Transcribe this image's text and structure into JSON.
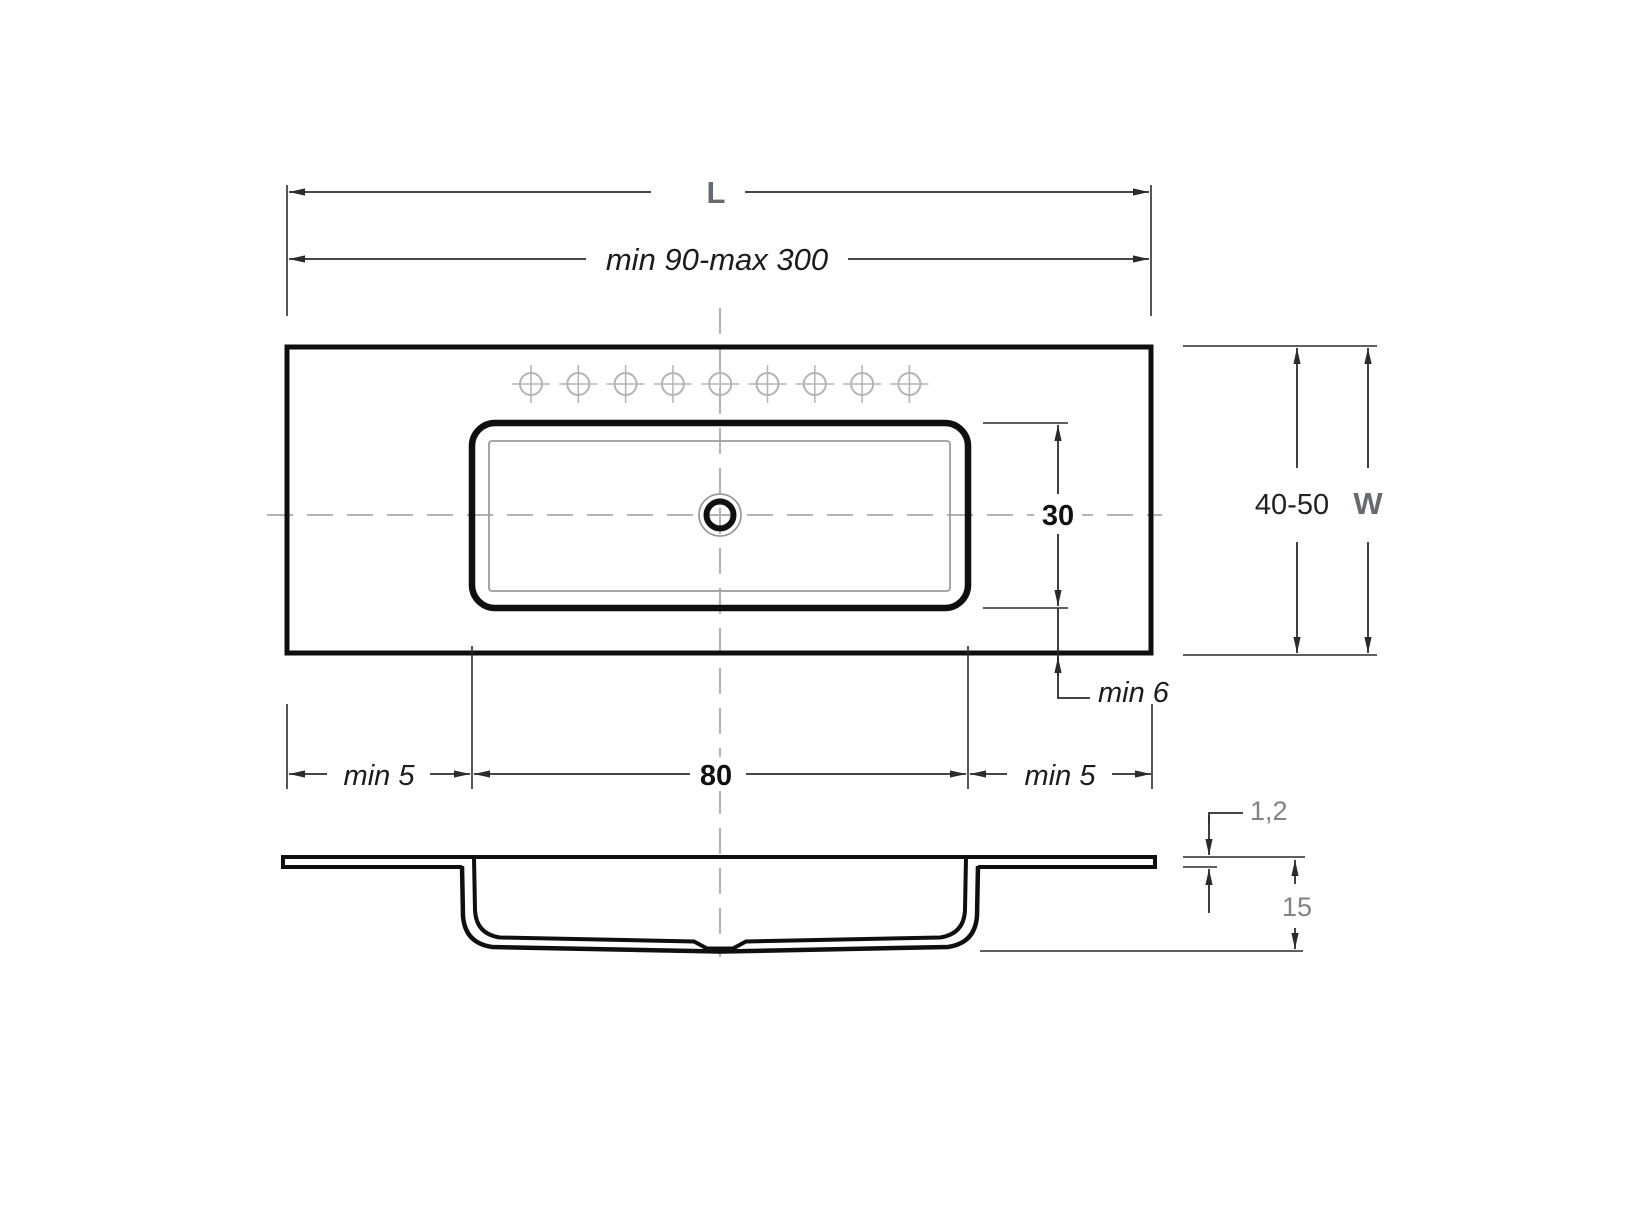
{
  "drawing": {
    "type": "washbasin-countertop-technical-drawing",
    "background": "#ffffff",
    "line_color": "#0f0f0f",
    "dimension_line_color": "#2b2b2b",
    "centerline_color": "#b3b3b3",
    "gray_label_color": "#666a6e",
    "soft_label_color": "#828282"
  },
  "dims": {
    "length_letter": "L",
    "length_range": "min 90-max 300",
    "width_range": "40-50",
    "width_letter": "W",
    "basin_height": "30",
    "rear_min_edge": "min 6",
    "basin_width": "80",
    "left_min_edge": "min 5",
    "right_min_edge": "min 5",
    "slab_thickness": "1,2",
    "bowl_depth": "15"
  },
  "plan": {
    "faucet_holes": {
      "count": 9,
      "marker": "crosshair-circle"
    },
    "drain": {
      "marker": "double-circle"
    }
  }
}
